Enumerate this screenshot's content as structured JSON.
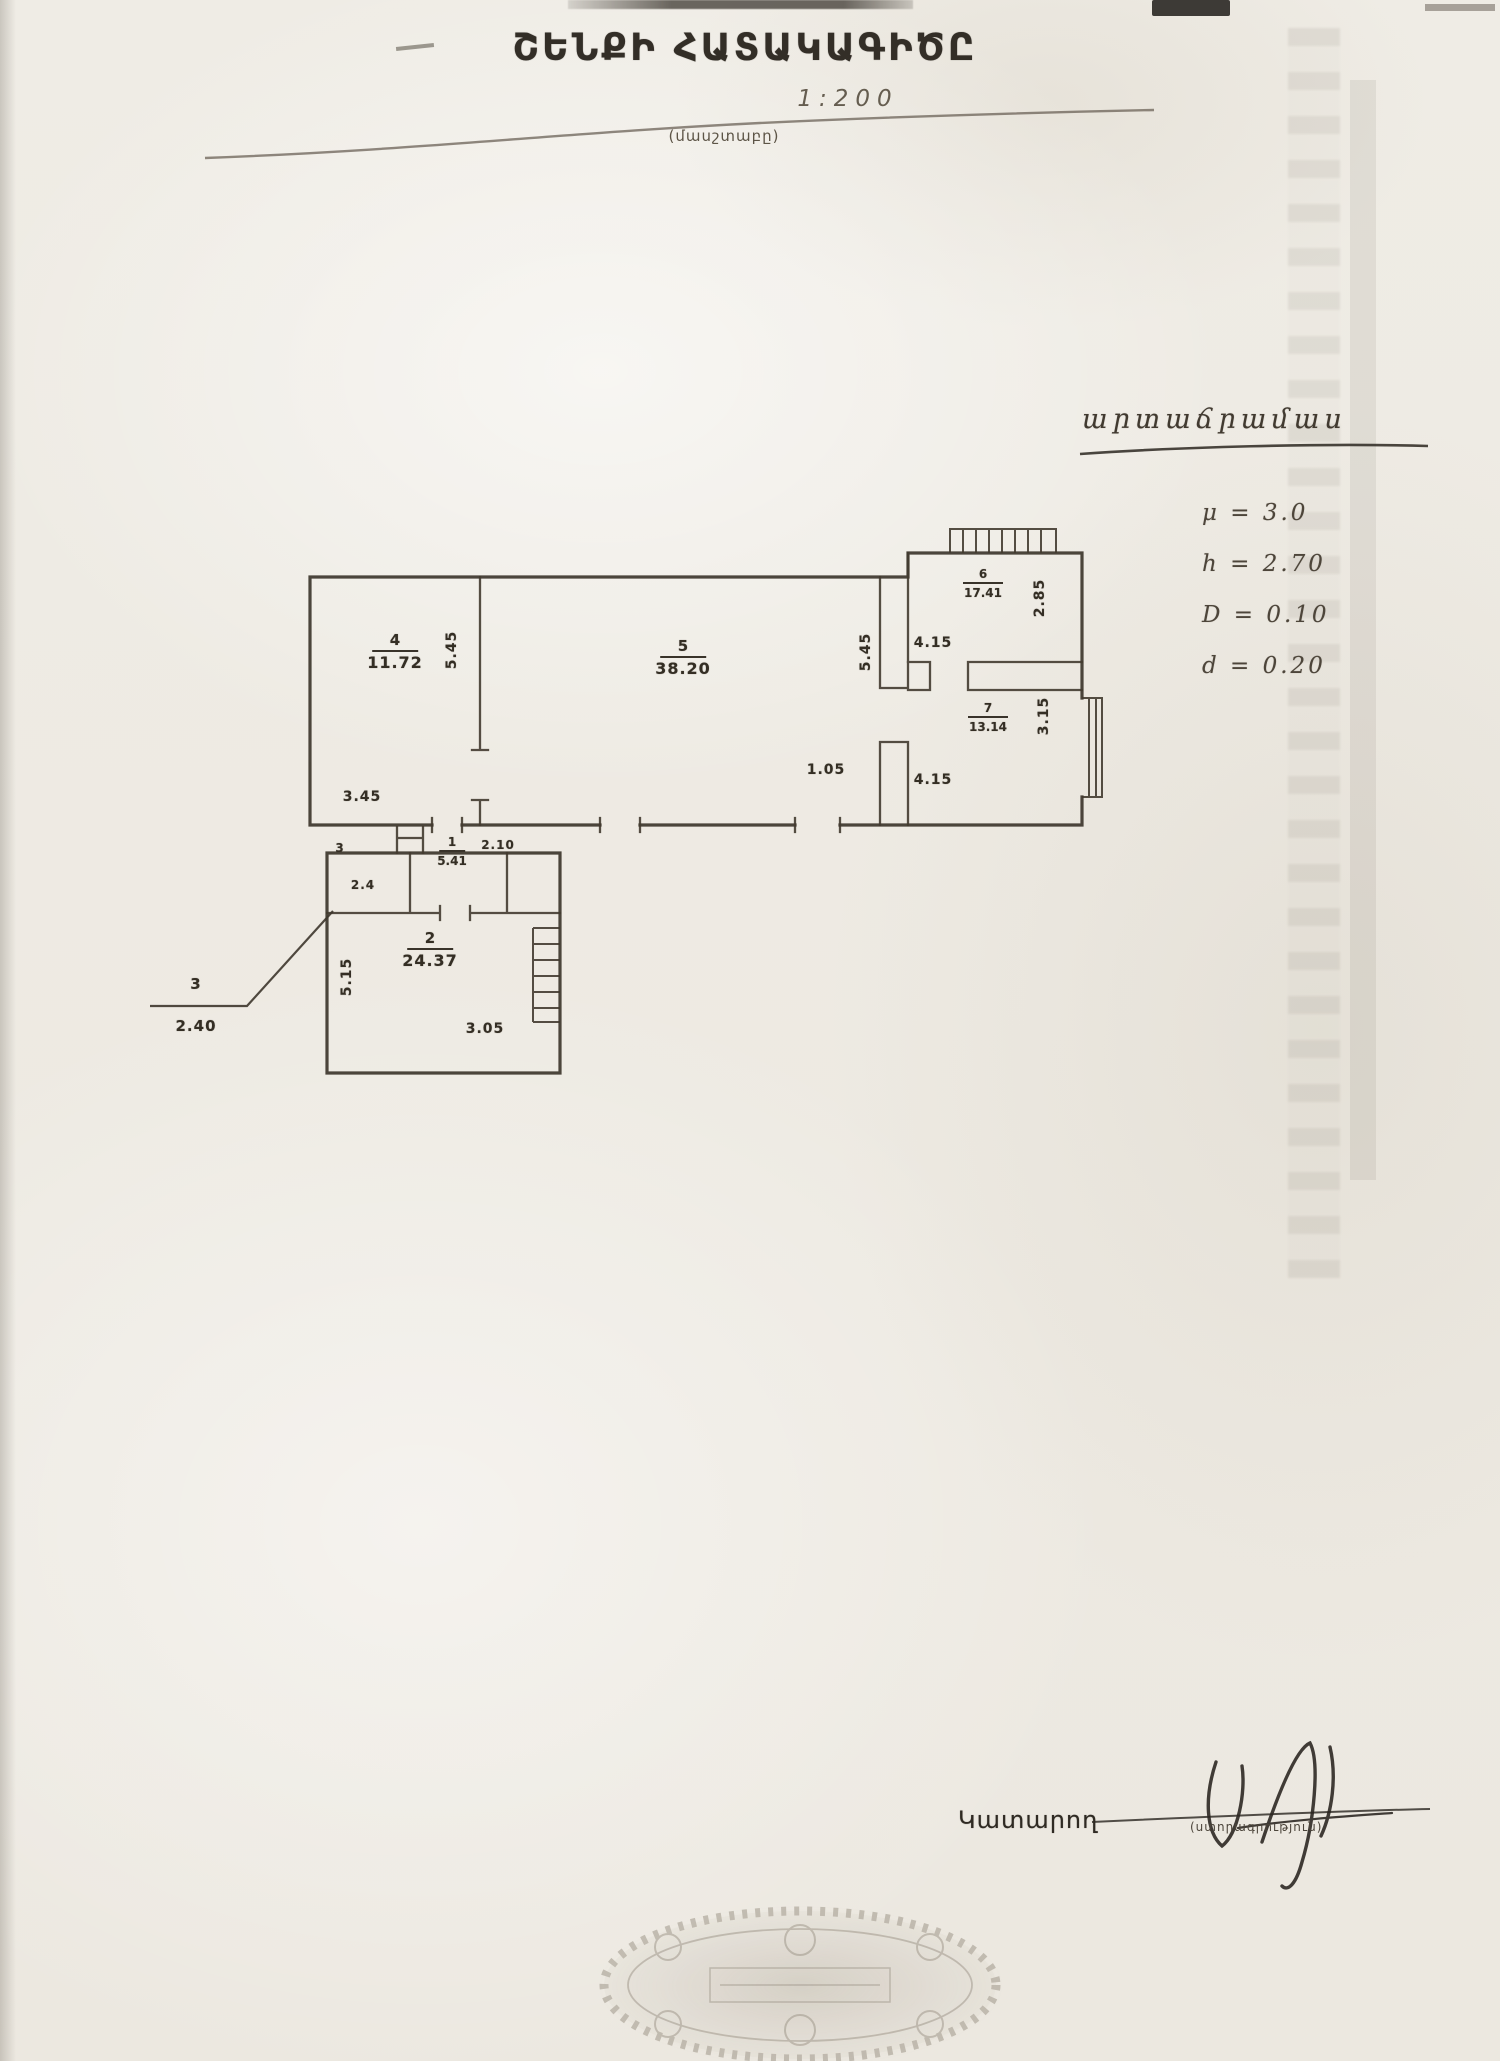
{
  "document": {
    "title": "ՇԵՆՔԻ ՀԱՏԱԿԱԳԻԾԸ",
    "scale": "1:200",
    "scale_caption": "(մասշտաբը)"
  },
  "notes": {
    "heading": "արտաճրամաս",
    "values": [
      "μ = 3.0",
      "h = 2.70",
      "D = 0.10",
      "d = 0.20"
    ]
  },
  "plan": {
    "rooms": [
      {
        "number": "4",
        "area": "11.72"
      },
      {
        "number": "5",
        "area": "38.20"
      },
      {
        "number": "6",
        "area": "17.41"
      },
      {
        "number": "7",
        "area": "13.14"
      },
      {
        "number": "1",
        "area": "5.41"
      },
      {
        "number": "2",
        "area": "24.37"
      }
    ],
    "room3": {
      "number": "3",
      "inline_area": "2.4"
    },
    "leader": {
      "number": "3",
      "area": "2.40"
    },
    "dims": {
      "room4_height": "5.45",
      "room4_width": "3.45",
      "room5_height": "5.45",
      "room5_width": "1.05",
      "room6_height": "2.85",
      "room6_width": "4.15",
      "room7_height": "3.15",
      "room7_width": "4.15",
      "room1_width": "2.10",
      "room2_height": "5.15",
      "room2_width": "3.05"
    }
  },
  "footer": {
    "executor_label": "Կատարող",
    "signature_caption": "(ստորագրություն)"
  }
}
